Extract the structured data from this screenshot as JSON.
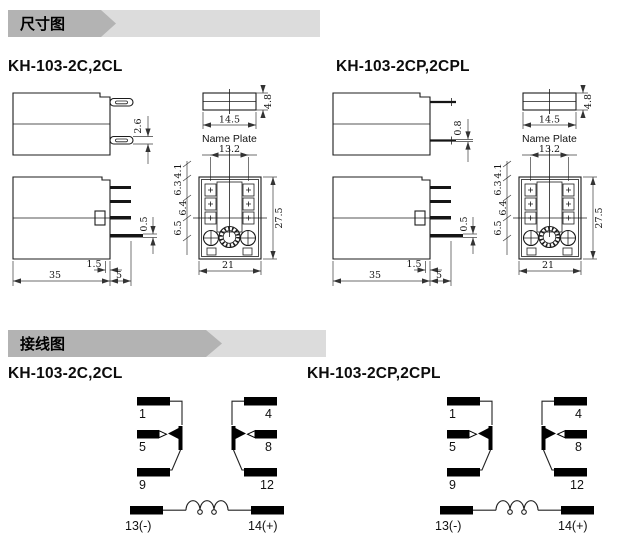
{
  "banners": {
    "dimension_label": "尺寸图",
    "wiring_label": "接线图",
    "colors": {
      "dark": "#b3b3b3",
      "light": "#dcdcdc"
    }
  },
  "models": {
    "standard": "KH-103-2C,2CL",
    "plugin": "KH-103-2CP,2CPL"
  },
  "dimensions": {
    "pin_width_blade": "2.6",
    "pin_width_round": "0.8",
    "body_width": "35",
    "pin_length": "5",
    "pin_offset": "1.5",
    "pin_thickness": "0.5",
    "nameplate_width": "14.5",
    "nameplate_height": "4.8",
    "nameplate_label": "Name Plate",
    "pin_span": "13.2",
    "socket_width": "21",
    "socket_height": "27.5",
    "pitch_1": "4.1",
    "pitch_2": "6.3",
    "pitch_3": "6.4",
    "pitch_4": "6.5"
  },
  "wiring": {
    "terminals": {
      "t1": "1",
      "t4": "4",
      "t5": "5",
      "t8": "8",
      "t9": "9",
      "t12": "12",
      "t13": "13(-)",
      "t14": "14(+)"
    }
  }
}
